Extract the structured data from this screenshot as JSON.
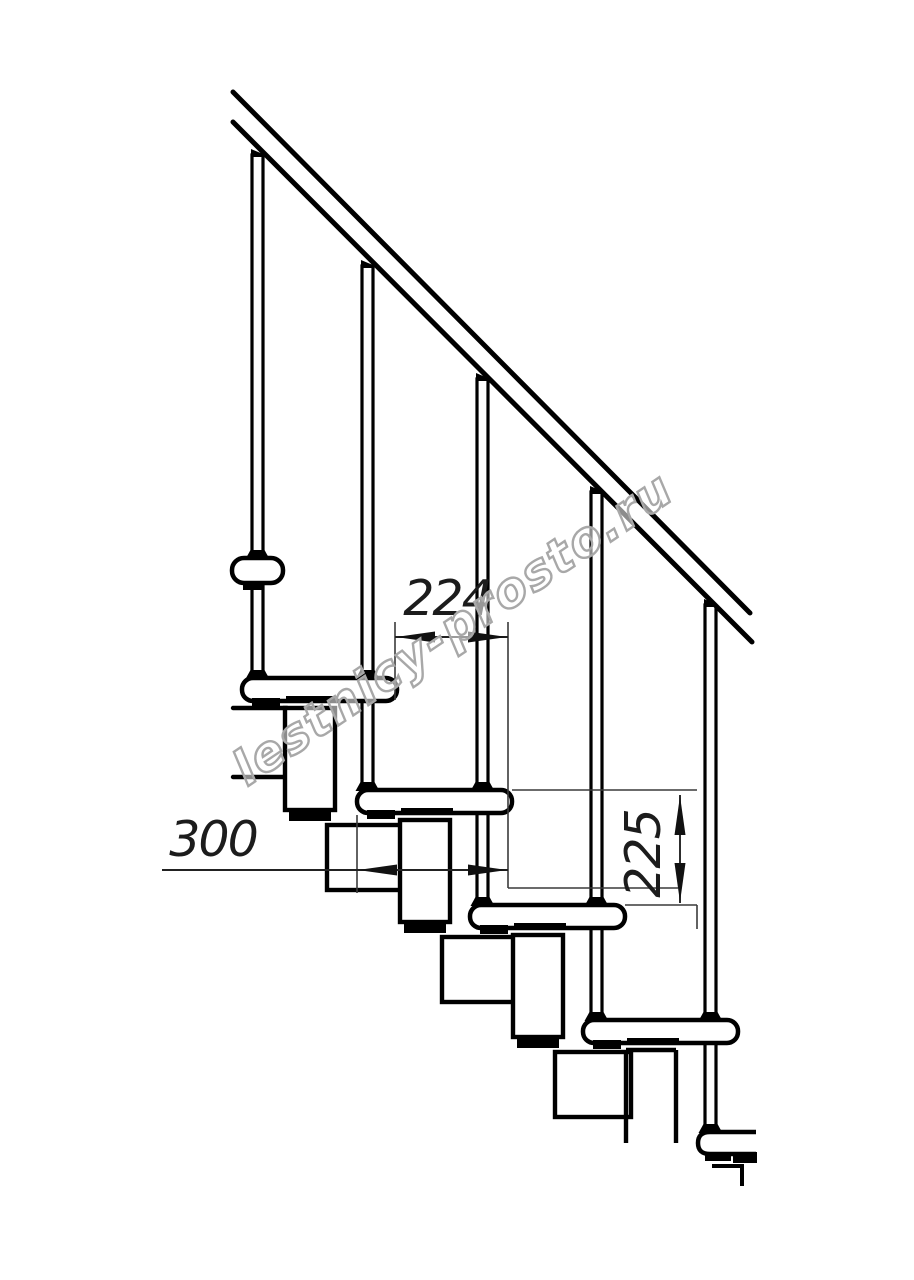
{
  "drawing": {
    "kind": "staircase-side-view-technical-drawing",
    "line_color": "#000000",
    "background_color": "#ffffff",
    "handrail": "diagonal handrail descending left to right",
    "balusters_visible": 5,
    "treads_visible": 6,
    "support": "modular chain of square sections under each tread"
  },
  "annotations": {
    "horizontal_spacing": "224",
    "tread_depth": "300",
    "step_rise": "225"
  },
  "watermark": {
    "text": "lestnicy-prosto.ru",
    "color": "#a8a8a8"
  }
}
